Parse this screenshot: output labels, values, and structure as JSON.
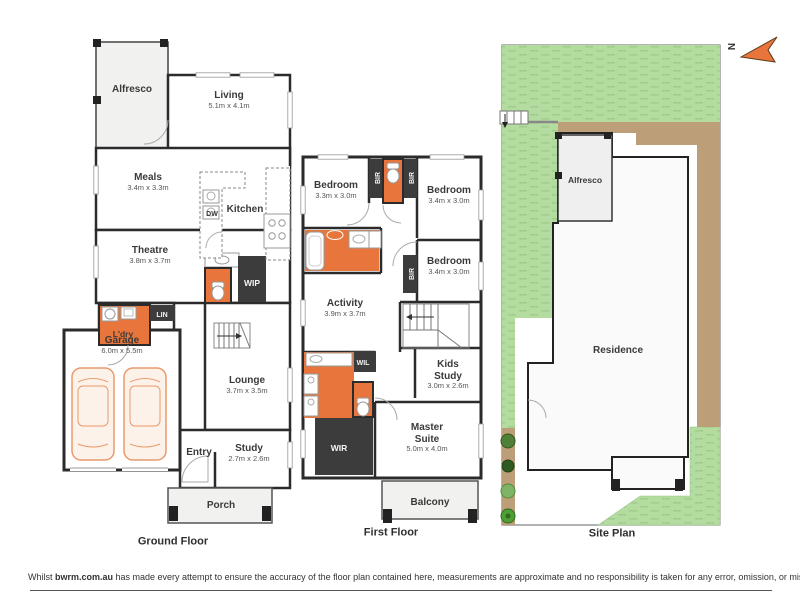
{
  "disclaimer": {
    "prefix": "Whilst ",
    "brand": "bwrm.com.au",
    "text": " has made every attempt to ensure the accuracy of the floor plan contained here, measurements are approximate and no responsibility is taken for any error, omission, or mis-statement. This plan is for illustrative purposes only."
  },
  "north_label": "N",
  "ground": {
    "title": "Ground Floor",
    "alfresco": {
      "name": "Alfresco"
    },
    "living": {
      "name": "Living",
      "dims": "5.1m x 4.1m"
    },
    "meals": {
      "name": "Meals",
      "dims": "3.4m x 3.3m"
    },
    "kitchen": {
      "name": "Kitchen",
      "dw": "DW"
    },
    "theatre": {
      "name": "Theatre",
      "dims": "3.8m x 3.7m"
    },
    "wip": {
      "name": "WIP"
    },
    "lin": {
      "name": "LIN"
    },
    "ldry": {
      "name": "L'dry"
    },
    "garage": {
      "name": "Garage",
      "dims": "6.0m x 5.5m"
    },
    "lounge": {
      "name": "Lounge",
      "dims": "3.7m x 3.5m"
    },
    "entry": {
      "name": "Entry"
    },
    "study": {
      "name": "Study",
      "dims": "2.7m x 2.6m"
    },
    "porch": {
      "name": "Porch"
    }
  },
  "first": {
    "title": "First Floor",
    "bed1": {
      "name": "Bedroom",
      "dims": "3.3m x 3.0m"
    },
    "bed2": {
      "name": "Bedroom",
      "dims": "3.4m x 3.0m"
    },
    "bed3": {
      "name": "Bedroom",
      "dims": "3.4m x 3.0m"
    },
    "bir": {
      "name": "BIR"
    },
    "activity": {
      "name": "Activity",
      "dims": "3.9m x 3.7m"
    },
    "wil": {
      "name": "WIL"
    },
    "kids_study": {
      "line1": "Kids",
      "line2": "Study",
      "dims": "3.0m x 2.6m"
    },
    "wir": {
      "name": "WIR"
    },
    "master": {
      "line1": "Master",
      "line2": "Suite",
      "dims": "5.0m x 4.0m"
    },
    "balcony": {
      "name": "Balcony"
    }
  },
  "site": {
    "title": "Site Plan",
    "residence": "Residence",
    "alfresco": "Alfresco"
  },
  "colors": {
    "wall": "#2b2b2b",
    "wet_area": "#E8763C",
    "closet": "#3c3c3c",
    "outdoor": "#f1f1f0",
    "grass": "#b4dca0",
    "path": "#bc9f79",
    "car": "#e99a6b"
  }
}
